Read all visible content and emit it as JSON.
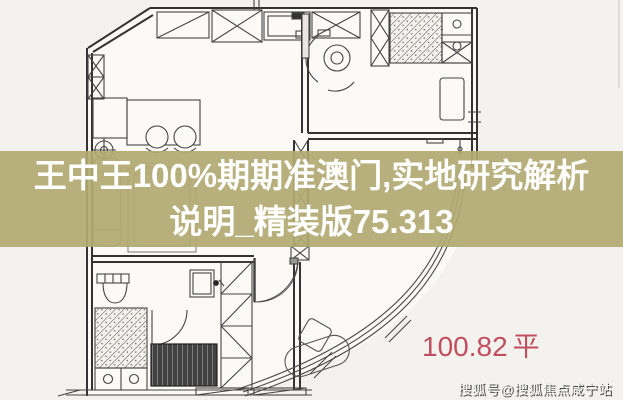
{
  "banner": {
    "line1": "王中王100%期期准澳门,实地研究解析",
    "line2": "说明_精装版75.313",
    "background_color": "#b2aa73",
    "text_color": "#ffffff"
  },
  "plan": {
    "area_value": "100.82",
    "area_unit": "平",
    "area_color": "#c14e5e"
  },
  "watermark": {
    "text": "搜狐号@搜狐焦点咸宁站"
  }
}
